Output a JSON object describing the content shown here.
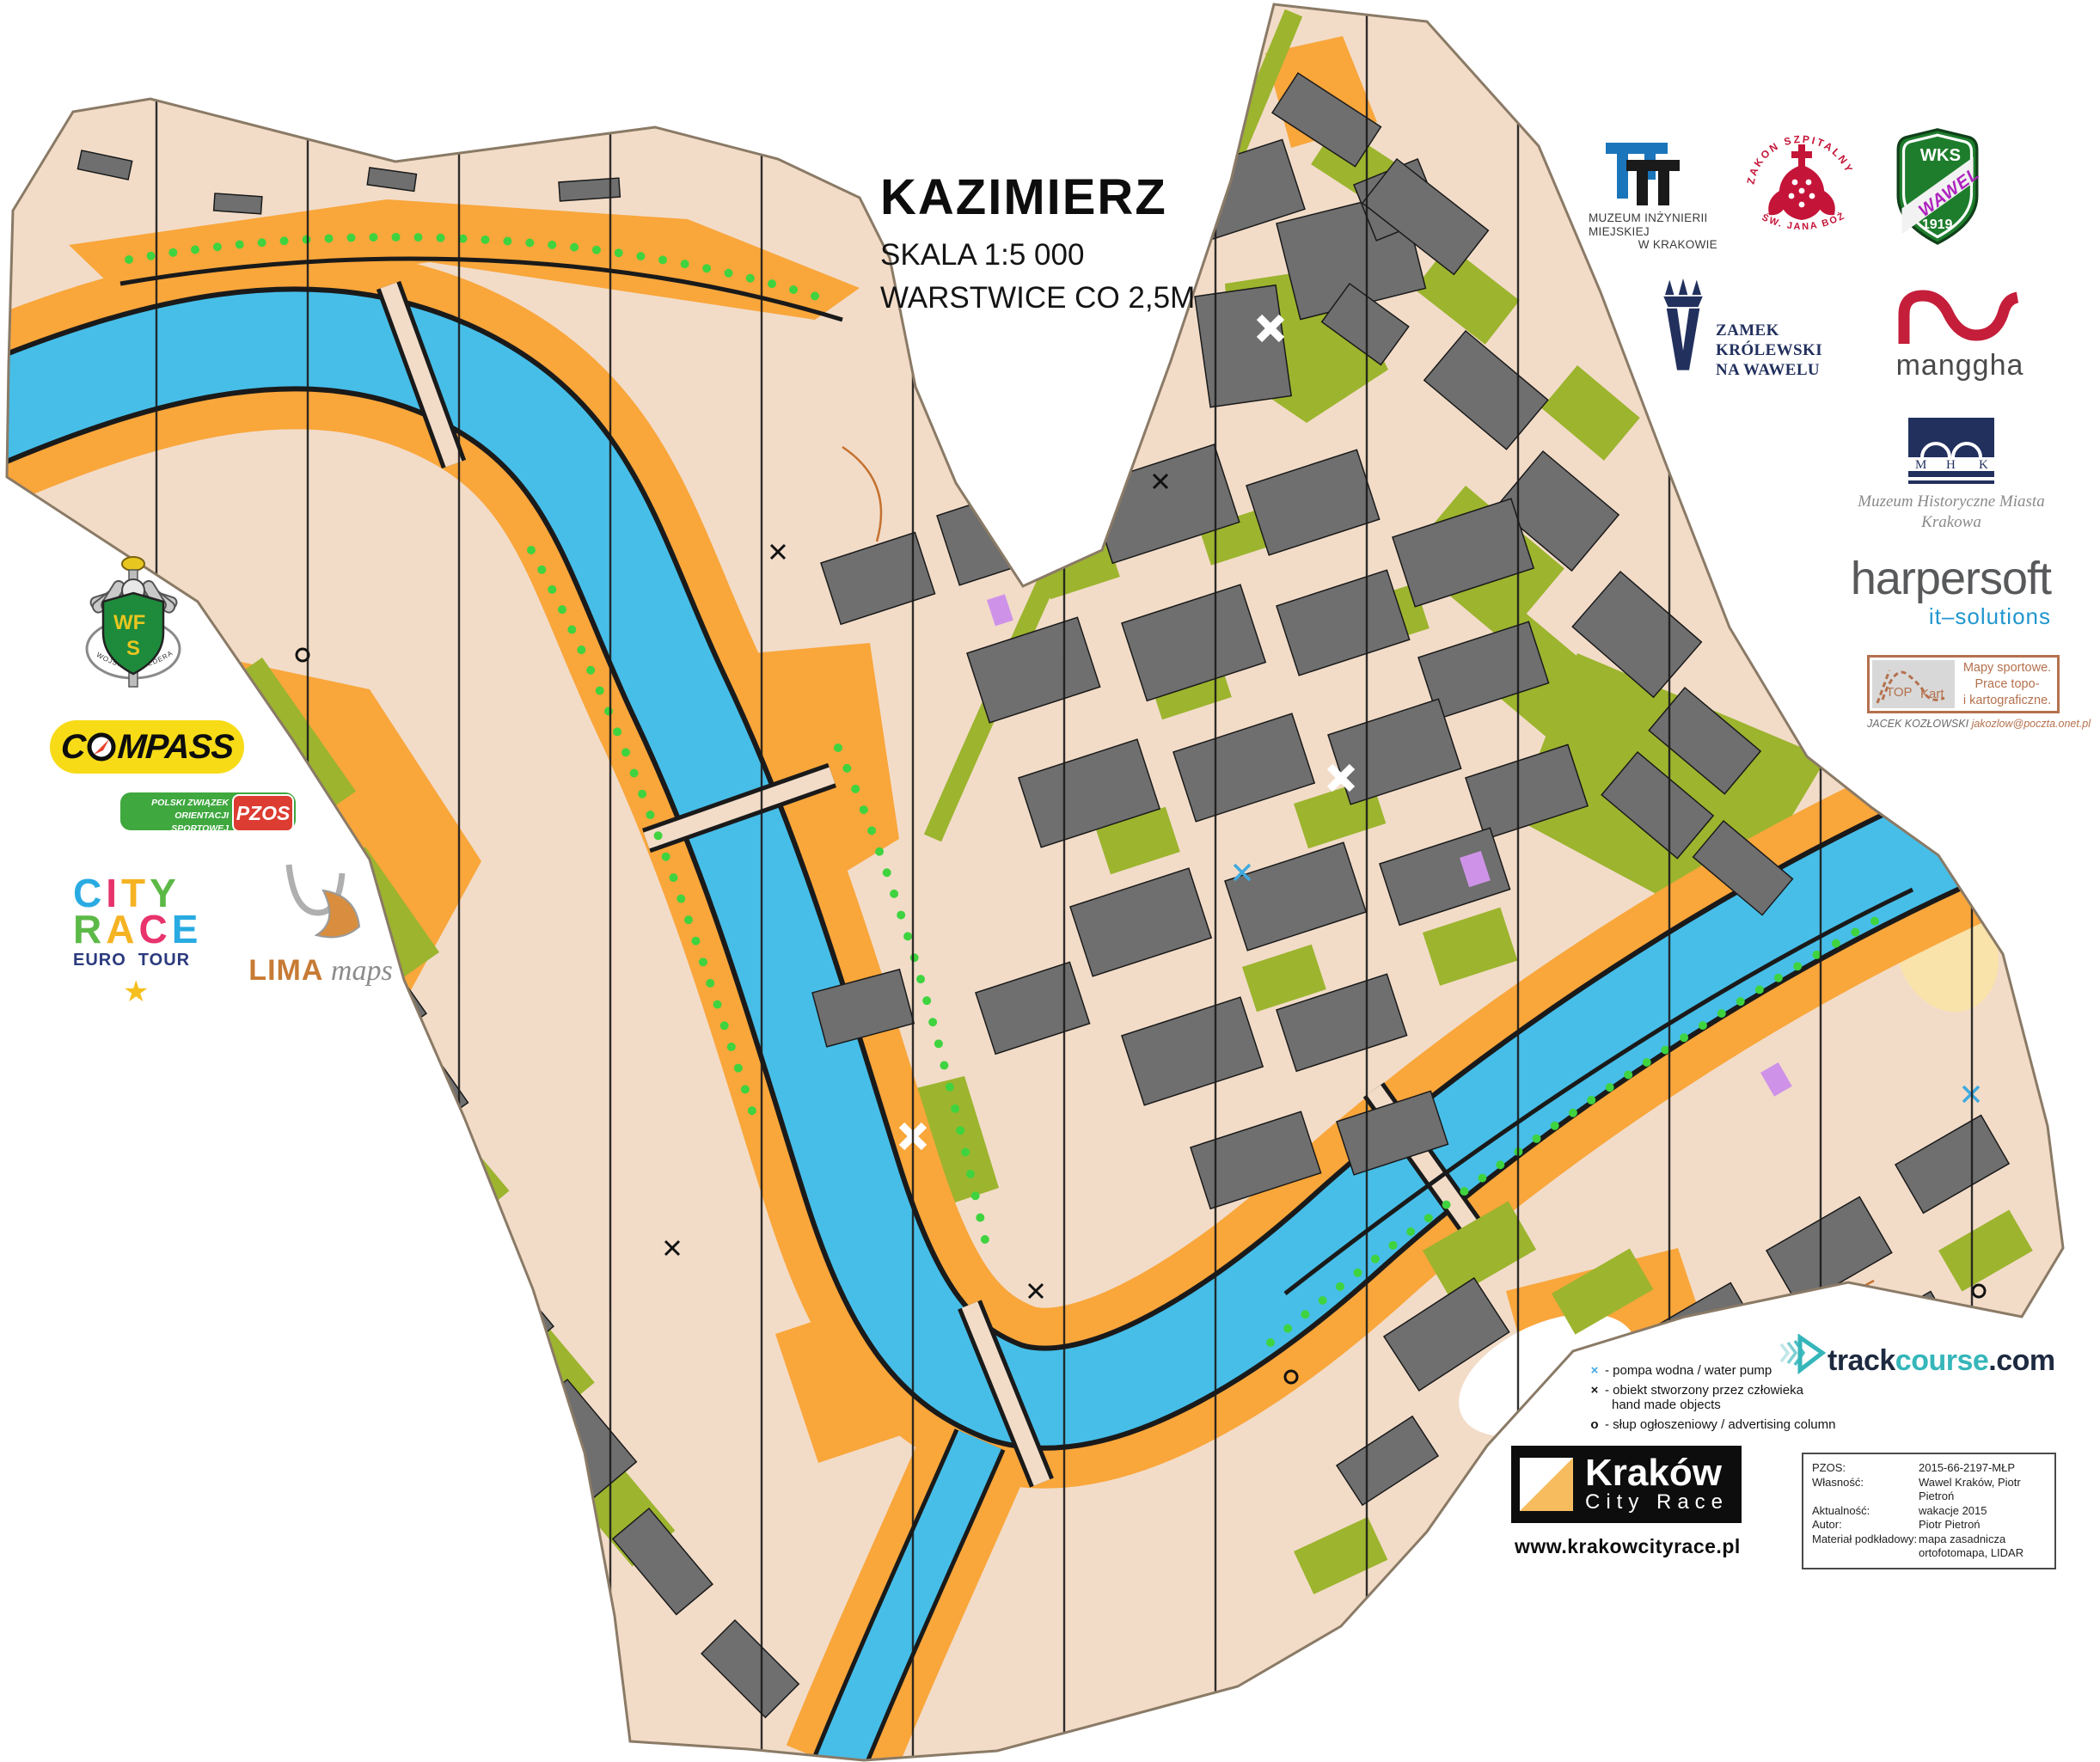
{
  "colors": {
    "water": "#47BEE8",
    "land": "#F2DCC8",
    "open-orange": "#F9A63B",
    "building": "#6F6F6F",
    "green": "#9DB42E",
    "dot-green": "#3FD33F",
    "sand": "#F9E3AA",
    "grid": "#1A1A1A",
    "contour": "#C5712F",
    "violet": "#CE93E8",
    "map-edge": "#8a7a66",
    "navy": "#22305E",
    "crimson": "#C41438",
    "manggha-red": "#C41E3A",
    "wks-green": "#1E7D2C",
    "wks-purple": "#AE23BE",
    "compass-yellow": "#F7DB17",
    "compass-red": "#E8402A",
    "pzos-green": "#3FA83F",
    "pzos-red": "#DC3C32",
    "sienna": "#B4714E",
    "euronavy": "#2B3A7E",
    "star-yellow": "#F5C01E",
    "legend-blue": "#3FA9E0",
    "teal": "#35B6BA",
    "kcr-orange": "#F6BC5E",
    "wfs-green": "#1E8A3C",
    "wfs-yellow": "#E8C620"
  },
  "cityrace_palette1": [
    "#29ABE2",
    "#E8336D",
    "#F5B324",
    "#5CB947"
  ],
  "cityrace_palette2": [
    "#5CB947",
    "#F5B324",
    "#E8336D",
    "#29ABE2"
  ],
  "title": {
    "heading": "KAZIMIERZ",
    "line1": "SKALA 1:5 000",
    "line2": "WARSTWICE CO 2,5M"
  },
  "legend": {
    "sym1": "×",
    "item1": "- pompa wodna / water pump",
    "sym2": "×",
    "item2": "- obiekt stworzony przez człowieka",
    "item2b": "hand made objects",
    "sym3": "o",
    "item3": "- słup ogłoszeniowy / advertising column"
  },
  "credits": {
    "r1l": "PZOS:",
    "r1v": "2015-66-2197-MŁP",
    "r2l": "Własność:",
    "r2v": "Wawel Kraków, Piotr Pietroń",
    "r3l": "Aktualność:",
    "r3v": "wakacje 2015",
    "r4l": "Autor:",
    "r4v": "Piotr Pietroń",
    "r5l": "Materiał podkładowy:",
    "r5v": "mapa zasadnicza",
    "r6l": "",
    "r6v": "ortofotomapa, LIDAR"
  },
  "event": {
    "name": "Kraków",
    "sub": "City Race",
    "url": "www.krakowcityrace.pl"
  },
  "sponsors": {
    "mim": {
      "l1": "MUZEUM INŻYNIERII",
      "l2": "MIEJSKIEJ",
      "l3": "W KRAKOWIE"
    },
    "zakon": {
      "top": "ZAKON SZPITALNY",
      "bottom": "ŚW. JANA BOŻEGO"
    },
    "wks": {
      "top": "WKS",
      "mid": "WAWEL",
      "year": "1919"
    },
    "zamek": {
      "l1": "ZAMEK",
      "l2": "KRÓLEWSKI",
      "l3": "NA WAWELU"
    },
    "manggha": {
      "name": "manggha"
    },
    "mhk": {
      "m": "M",
      "h": "H",
      "k": "K",
      "l1": "Muzeum Historyczne Miasta",
      "l2": "Krakowa"
    },
    "harpersoft": {
      "name": "harpersoft",
      "sub": "it–solutions"
    },
    "topkart": {
      "top": "TOP",
      "kart": "Kart",
      "r1": "Mapy sportowe.",
      "r2": "Prace topo-",
      "r3": "i kartograficzne.",
      "author": "JACEK KOZŁOWSKI",
      "email": "jakozlow@poczta.onet.pl"
    },
    "wfs": {
      "wf": "WF",
      "s": "S",
      "banner": "WOJSKOWA FEDERACJA SPORTU"
    },
    "compass": {
      "pre": "C",
      "post": "MPASS"
    },
    "pzos": {
      "l1": "POLSKI ZWIĄZEK",
      "l2": "ORIENTACJI SPORTOWEJ",
      "abbr": "PZOS"
    },
    "cityrace": {
      "w1": "CITY",
      "w2": "RACE",
      "w3": "EURO",
      "w4": "TOUR",
      "star": "★"
    },
    "lima": {
      "name": "LIMA",
      "sub": " maps"
    },
    "trackcourse": {
      "p1": "track",
      "p2": "course",
      "p3": ".com"
    }
  }
}
